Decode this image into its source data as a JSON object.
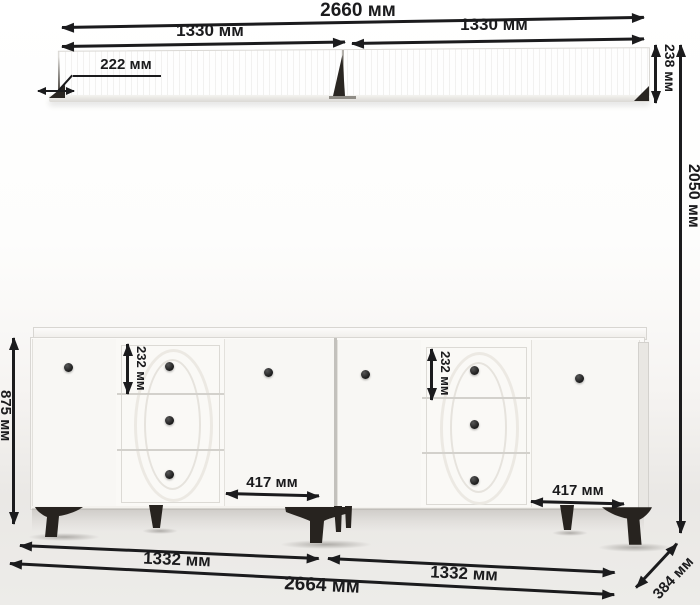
{
  "dims": {
    "shelf_total_width": "2660 мм",
    "shelf_left_width": "1330 мм",
    "shelf_right_width": "1330 мм",
    "shelf_depth": "222 мм",
    "shelf_height": "238 мм",
    "overall_height": "2050 мм",
    "cabinet_height": "875 мм",
    "drawer_height_left": "232 мм",
    "drawer_height_right": "232 мм",
    "door_width_left": "417 мм",
    "door_width_right": "417 мм",
    "cabinet_left_width": "1332 мм",
    "cabinet_right_width": "1332 мм",
    "cabinet_total_width": "2664 мм",
    "cabinet_depth": "384 мм"
  },
  "colors": {
    "dimension_ink": "#1b1b1d",
    "furniture_white": "#f8f7f4",
    "leg_black": "#27231f",
    "knob_black": "#191919"
  }
}
